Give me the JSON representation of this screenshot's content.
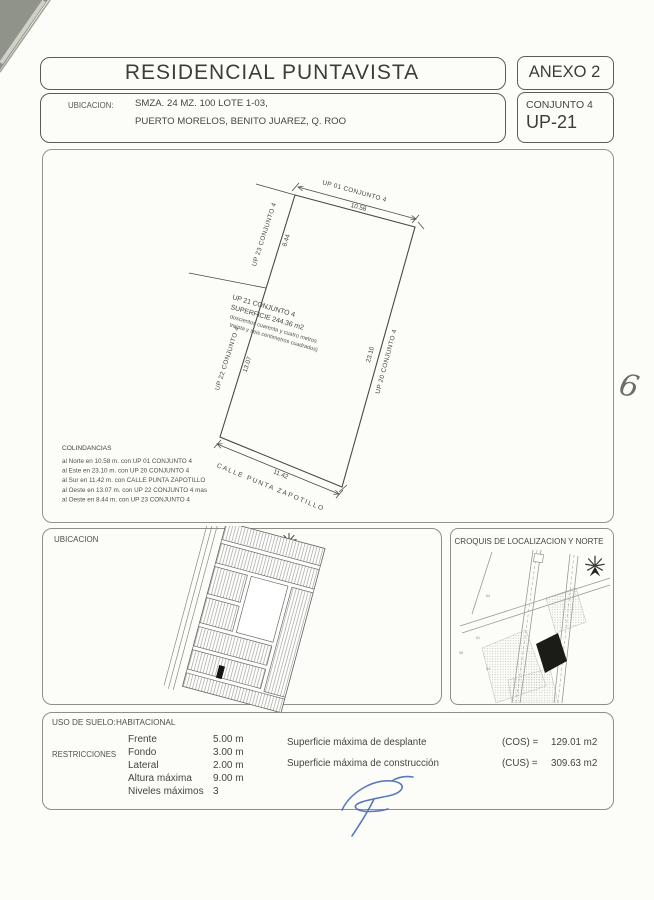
{
  "header": {
    "title": "RESIDENCIAL PUNTAVISTA",
    "annex_label": "ANEXO 2",
    "location_label": "UBICACION:",
    "location_line1": "SMZA. 24 MZ. 100 LOTE 1-03,",
    "location_line2": "PUERTO MORELOS, BENITO JUAREZ, Q. ROO",
    "conjunto_label": "CONJUNTO 4",
    "unit_label": "UP-21"
  },
  "site_plan": {
    "north_neighbor": "UP 01 CONJUNTO 4",
    "north_dim": "10.58",
    "east_neighbor": "UP 20 CONJUNTO 4",
    "east_dim": "23.10",
    "south_street": "CALLE PUNTA ZAPOTILLO",
    "south_dim": "11.42",
    "west_lower_neighbor": "UP 22 CONJUNTO 4",
    "west_lower_dim": "13.07",
    "west_upper_neighbor": "UP 23 CONJUNTO 4",
    "west_upper_dim": "8.44",
    "lot_name": "UP 21 CONJUNTO 4",
    "lot_area": "SUPERFICIE 244.36 m2",
    "lot_area_words_line1": "doscientos cuarenta y cuatro metros",
    "lot_area_words_line2": "treinta y seis centimetros cuadrados)",
    "colindancias_title": "COLINDANCIAS",
    "colindancias": [
      "al Norte en 10.58 m. con UP 01 CONJUNTO 4",
      "al Este en 23.10 m. con UP 20 CONJUNTO 4",
      "al Sur en 11.42 m. con CALLE PUNTA ZAPOTILLO",
      "al Oeste en 13.07 m. con UP 22 CONJUNTO 4 mas",
      "al Oeste en 8.44 m. con UP 23 CONJUNTO 4"
    ]
  },
  "location_map": {
    "title": "UBICACION"
  },
  "croquis": {
    "title": "CROQUIS DE LOCALIZACION Y NORTE",
    "lot_numbers": [
      "64",
      "61",
      "58",
      "54"
    ]
  },
  "zoning": {
    "land_use_label": "USO DE SUELO:",
    "land_use_value": "HABITACIONAL",
    "restrictions_label": "RESTRICCIONES",
    "restrictions": [
      {
        "label": "Frente",
        "value": "5.00 m"
      },
      {
        "label": "Fondo",
        "value": "3.00 m"
      },
      {
        "label": "Lateral",
        "value": "2.00 m"
      },
      {
        "label": "Altura máxima",
        "value": "9.00 m"
      },
      {
        "label": "Niveles máximos",
        "value": "3"
      }
    ],
    "coefficients": [
      {
        "label": "Superficie máxima de desplante",
        "key": "(COS) =",
        "value": "129.01 m2"
      },
      {
        "label": "Superficie máxima de construcción",
        "key": "(CUS) =",
        "value": "309.63 m2"
      }
    ]
  },
  "marks": {
    "margin_note": "6"
  },
  "colors": {
    "signature_ink": "#4a6cb3",
    "paper": "#fcfcf9",
    "line": "#55554f"
  }
}
